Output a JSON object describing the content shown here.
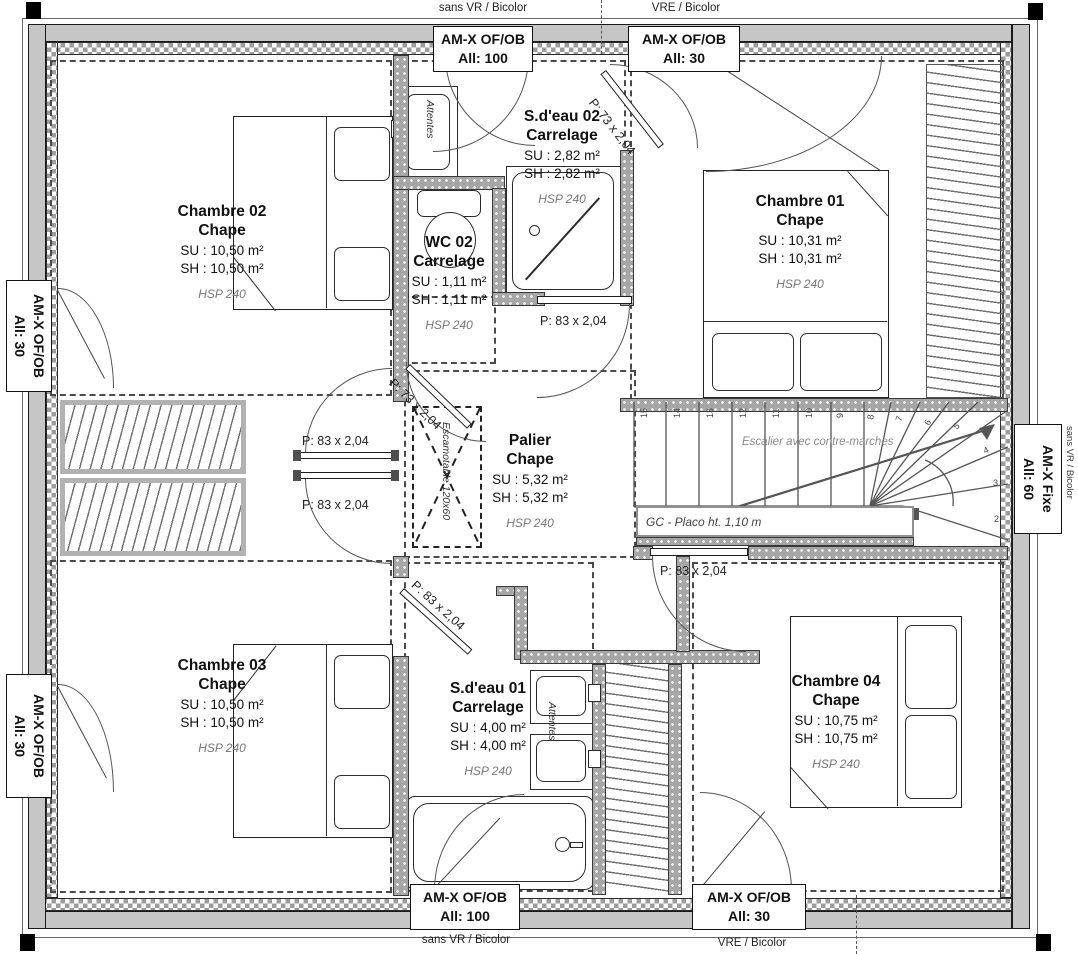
{
  "plan": {
    "rooms": [
      {
        "name": "Chambre 02",
        "finish": "Chape",
        "su": "SU : 10,50 m²",
        "sh": "SH : 10,50 m²",
        "hsp": "HSP 240"
      },
      {
        "name": "S.d'eau 02",
        "finish": "Carrelage",
        "su": "SU : 2,82 m²",
        "sh": "SH : 2,82 m²",
        "hsp": "HSP 240"
      },
      {
        "name": "WC 02",
        "finish": "Carrelage",
        "su": "SU : 1,11 m²",
        "sh": "SH : 1,11 m²",
        "hsp": "HSP 240"
      },
      {
        "name": "Chambre 01",
        "finish": "Chape",
        "su": "SU : 10,31 m²",
        "sh": "SH : 10,31 m²",
        "hsp": "HSP 240"
      },
      {
        "name": "Palier",
        "finish": "Chape",
        "su": "SU : 5,32 m²",
        "sh": "SH : 5,32 m²",
        "hsp": "HSP 240"
      },
      {
        "name": "Chambre 03",
        "finish": "Chape",
        "su": "SU : 10,50 m²",
        "sh": "SH : 10,50 m²",
        "hsp": "HSP 240"
      },
      {
        "name": "S.d'eau 01",
        "finish": "Carrelage",
        "su": "SU : 4,00 m²",
        "sh": "SH : 4,00 m²",
        "hsp": "HSP 240"
      },
      {
        "name": "Chambre 04",
        "finish": "Chape",
        "su": "SU : 10,75 m²",
        "sh": "SH : 10,75 m²",
        "hsp": "HSP 240"
      }
    ],
    "windows": [
      {
        "line1": "AM-X OF/OB",
        "line2": "All:  100",
        "note": "sans VR / Bicolor"
      },
      {
        "line1": "AM-X OF/OB",
        "line2": "All:  30",
        "note": "VRE / Bicolor"
      },
      {
        "line1": "AM-X OF/OB",
        "line2": "All:  30",
        "note": ""
      },
      {
        "line1": "AM-X OF/OB",
        "line2": "All:  30",
        "note": ""
      },
      {
        "line1": "AM-X Fixe",
        "line2": "All:  60",
        "note": "sans VR / Bicolor"
      },
      {
        "line1": "AM-X OF/OB",
        "line2": "All:  100",
        "note": "sans VR / Bicolor"
      },
      {
        "line1": "AM-X OF/OB",
        "line2": "All:  30",
        "note": "VRE / Bicolor"
      }
    ],
    "doors": [
      {
        "label": "P: 73 x 2,04"
      },
      {
        "label": "P: 83 x 2,04"
      },
      {
        "label": "P: 73 x 2,04"
      },
      {
        "label": "P: 83 x 2,04"
      },
      {
        "label": "P: 83 x 2,04"
      },
      {
        "label": "P: 83 x 2,04"
      },
      {
        "label": "P: 83 x 2,04"
      }
    ],
    "stairs": {
      "label": "Escalier avec contre-marches",
      "gc_label": "GC - Placo ht. 1,10 m",
      "steps": [
        "15",
        "14",
        "13",
        "12",
        "11",
        "10",
        "9",
        "8",
        "7",
        "6",
        "5",
        "4",
        "3",
        "2"
      ]
    },
    "tremie_label": "Escamotable 120x60",
    "attentes_label": "Attentes"
  }
}
